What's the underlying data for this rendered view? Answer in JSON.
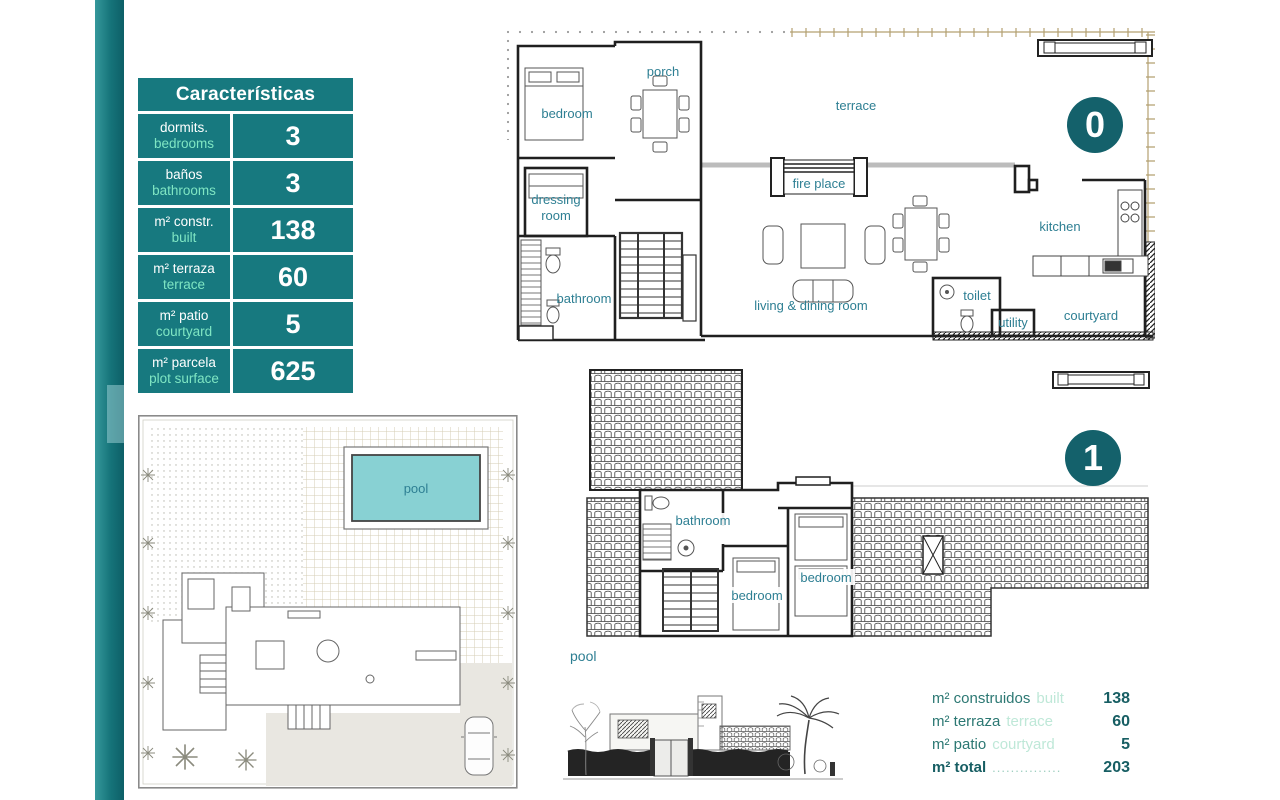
{
  "colors": {
    "teal": "#17797f",
    "teal_dark_badge": "#14616b",
    "mint": "#7fe6c3",
    "room_label_teal": "#2e7f93",
    "pool_fill": "#88d1d3",
    "ruler_tan": "#b3a070"
  },
  "table": {
    "title": "Características",
    "rows": [
      {
        "es": "dormits.",
        "en": "bedrooms",
        "value": "3"
      },
      {
        "es": "baños",
        "en": "bathrooms",
        "value": "3"
      },
      {
        "es": "m² constr.",
        "en": "built",
        "value": "138"
      },
      {
        "es": "m² terraza",
        "en": "terrace",
        "value": "60"
      },
      {
        "es": "m² patio",
        "en": "courtyard",
        "value": "5"
      },
      {
        "es": "m² parcela",
        "en": "plot surface",
        "value": "625"
      }
    ]
  },
  "floor0": {
    "badge": "0",
    "rooms": {
      "porch": "porch",
      "bedroom": "bedroom",
      "terrace": "terrace",
      "dressing_1": "dressing",
      "dressing_2": "room",
      "fire_place": "fire place",
      "bathroom": "bathroom",
      "living_dining": "living & dining room",
      "kitchen": "kitchen",
      "toilet": "toilet",
      "utility": "utility",
      "courtyard": "courtyard"
    }
  },
  "floor1": {
    "badge": "1",
    "rooms": {
      "bathroom": "bathroom",
      "bedroom_left": "bedroom",
      "bedroom_right": "bedroom"
    },
    "pool_label": "pool"
  },
  "siteplan": {
    "pool_label": "pool"
  },
  "summary": {
    "rows": [
      {
        "es": "m² construidos",
        "en": "built",
        "value": "138"
      },
      {
        "es": "m² terraza",
        "en": "terrace",
        "value": "60"
      },
      {
        "es": "m² patio",
        "en": "courtyard",
        "value": "5"
      }
    ],
    "total": {
      "es": "m² total",
      "dots": "...............",
      "value": "203"
    }
  }
}
